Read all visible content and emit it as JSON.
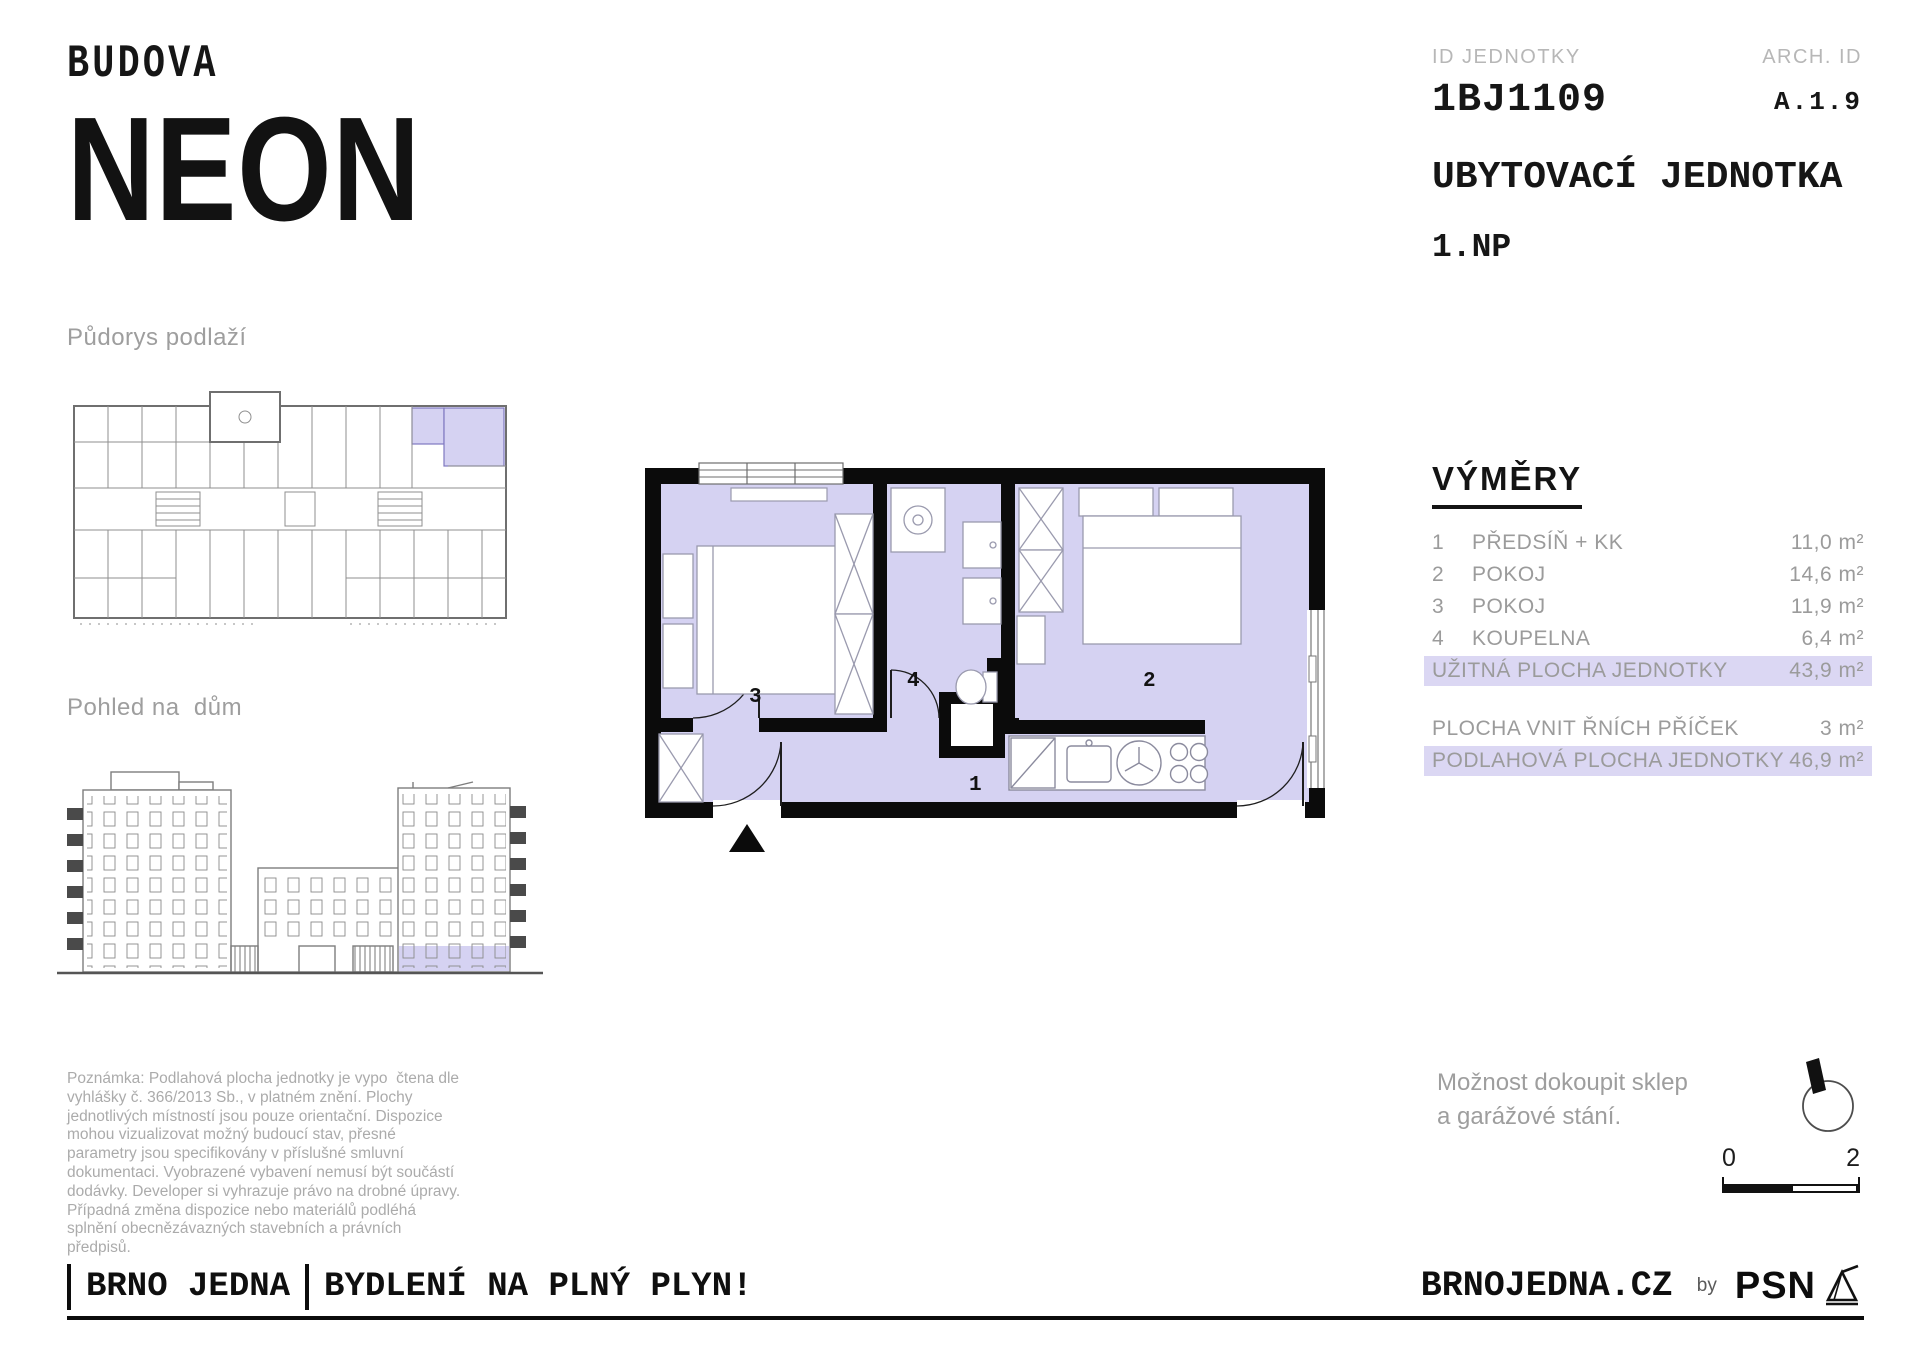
{
  "brand": {
    "building_label": "BUDOVA",
    "building_name": "NEON"
  },
  "header": {
    "id_label": "ID JEDNOTKY",
    "id_value": "1BJ1109",
    "arch_label": "ARCH. ID",
    "arch_value": "A.1.9",
    "unit_type": "UBYTOVACÍ JEDNOTKA",
    "floor": "1.NP"
  },
  "sections": {
    "floorplan_overview_title": "Půdorys podlaží",
    "elevation_title": "Pohled na  dům"
  },
  "plan": {
    "rooms": {
      "r1": "1",
      "r2": "2",
      "r3": "3",
      "r4": "4"
    }
  },
  "areas": {
    "title": "VÝMĚRY",
    "rows": [
      {
        "num": "1",
        "label": "PŘEDSÍŇ + KK",
        "value": "11,0 m²"
      },
      {
        "num": "2",
        "label": "POKOJ",
        "value": "14,6 m²"
      },
      {
        "num": "3",
        "label": "POKOJ",
        "value": "11,9 m²"
      },
      {
        "num": "4",
        "label": "KOUPELNA",
        "value": "6,4 m²"
      }
    ],
    "summary_rows": [
      {
        "label": "UŽITNÁ PLOCHA JEDNOTKY",
        "value": "43,9 m²",
        "highlighted": true
      },
      {
        "label": "PLOCHA VNIT ŘNÍCH PŘÍČEK",
        "value": "3 m²",
        "highlighted": false
      },
      {
        "label": "PODLAHOVÁ PLOCHA JEDNOTKY",
        "value": "46,9 m²",
        "highlighted": true
      }
    ]
  },
  "note": "Poznámka: Podlahová plocha jednotky je vypo  čtena dle vyhlášky č. 366/2013 Sb., v platném znění. Plochy jednotlivých místností jsou pouze orientační. Dispozice mohou vizualizovat možný budoucí stav, přesné parametry jsou specifikovány v příslušné smluvní dokumentaci. Vyobrazené vybavení nemusí být součástí dodávky. Developer si vyhrazuje právo na drobné úpravy. Případná změna dispozice nebo materiálů podléhá splnění obecnězávazných stavebních a právních předpisů.",
  "extras": {
    "line1": "Možnost dokoupit sklep",
    "line2": "a garážové stání."
  },
  "scale_bar": {
    "start": "0",
    "end": "2"
  },
  "footer": {
    "brand_left": "BRNO JEDNA",
    "slogan": "BYDLENÍ NA PLNÝ PLYN!",
    "website": "BRNOJEDNA.CZ",
    "by_label": "by",
    "publisher": "PSN"
  },
  "colors": {
    "unit_highlight": "#d5d2f2",
    "row_highlight": "#dbd7f3",
    "wall_black": "#0b0b0b",
    "muted_text": "#9b9b9b"
  }
}
